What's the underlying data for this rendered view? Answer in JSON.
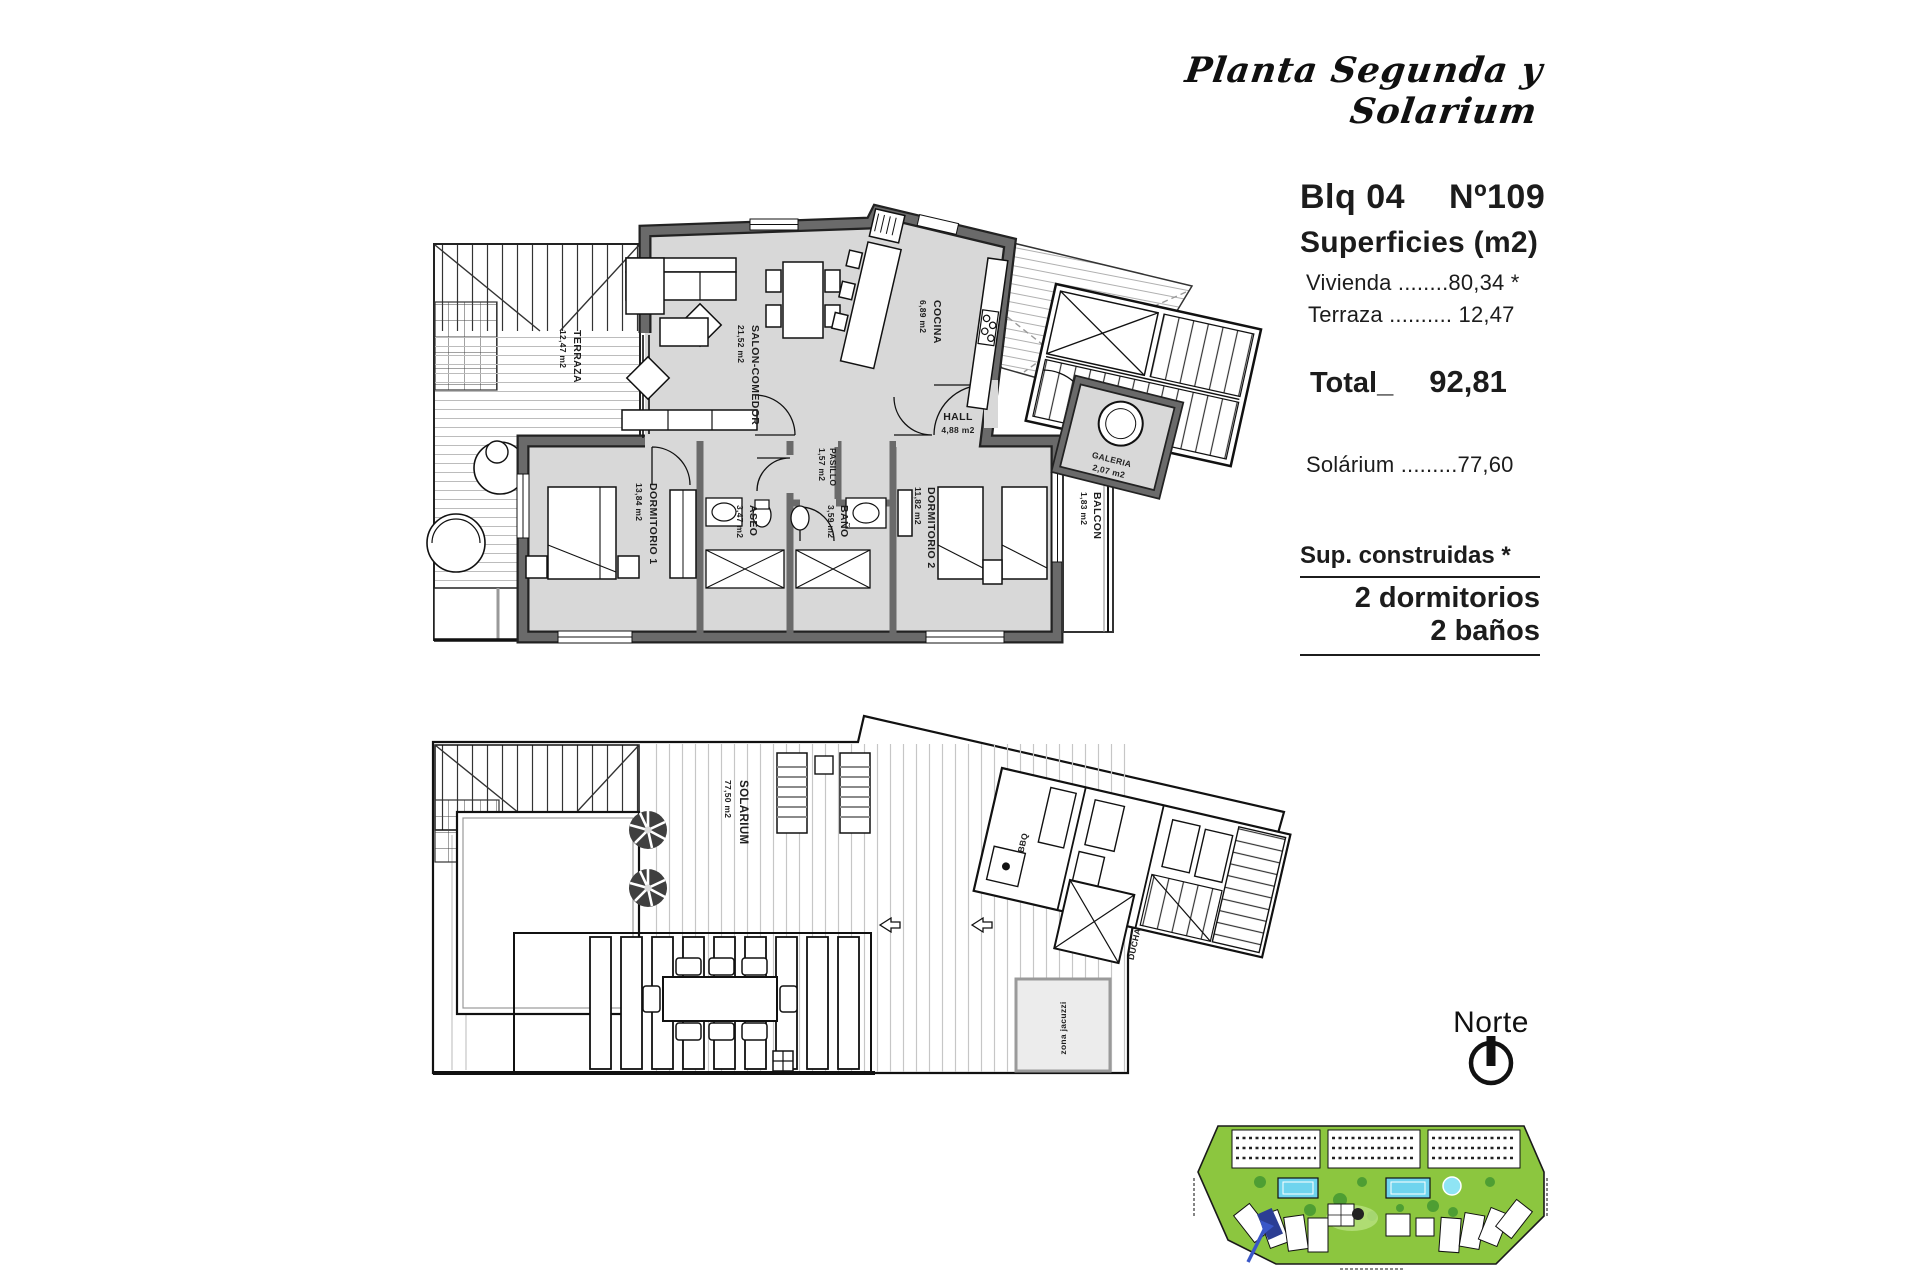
{
  "header": {
    "title": "Planta Segunda y Solarium"
  },
  "panel": {
    "block": "Blq 04",
    "unit": "Nº109",
    "surfaces_title": "Superficies (m2)",
    "vivienda": "Vivienda ........80,34 *",
    "terraza": "Terraza .......... 12,47",
    "total_label": "Total_",
    "total_value": "92,81",
    "solarium": "Solárium .........77,60",
    "sup_label": "Sup. construidas *",
    "bedrooms": "2 dormitorios",
    "bathrooms": "2 baños"
  },
  "north": {
    "label": "Norte"
  },
  "plan": {
    "terraza": {
      "name": "TERRAZA",
      "area": "12,47 m2"
    },
    "salon": {
      "name": "SALON-COMEDOR",
      "area": "21,52 m2"
    },
    "cocina": {
      "name": "COCINA",
      "area": "6,89 m2"
    },
    "hall": {
      "name": "HALL",
      "area": "4,88 m2"
    },
    "galeria": {
      "name": "GALERIA",
      "area": "2,07 m2"
    },
    "pasillo": {
      "name": "PASILLO",
      "area": "1,57 m2"
    },
    "dorm1": {
      "name": "DORMITORIO 1",
      "area": "13,84 m2"
    },
    "aseo": {
      "name": "ASEO",
      "area": "3,47 m2"
    },
    "bano": {
      "name": "BAÑO",
      "area": "3,59 m2"
    },
    "dorm2": {
      "name": "DORMITORIO 2",
      "area": "11,82 m2"
    },
    "balcon": {
      "name": "BALCON",
      "area": "1,83 m2"
    }
  },
  "solarium": {
    "main": {
      "name": "SOLARIUM",
      "area": "77,50 m2"
    },
    "bbq": "BBQ",
    "ducha": "DUCHA",
    "jacuzzi": "zona jacuzzi"
  },
  "colors": {
    "wall": "#6a6a6a",
    "wall_edge": "#222222",
    "floor": "#d8d8d8",
    "deck_line": "#bcbcbc",
    "site_green": "#8cc63f",
    "pool_blue": "#6fd4ee",
    "highlight_navy": "#2c3e94",
    "arrow_blue": "#3a57c8"
  }
}
